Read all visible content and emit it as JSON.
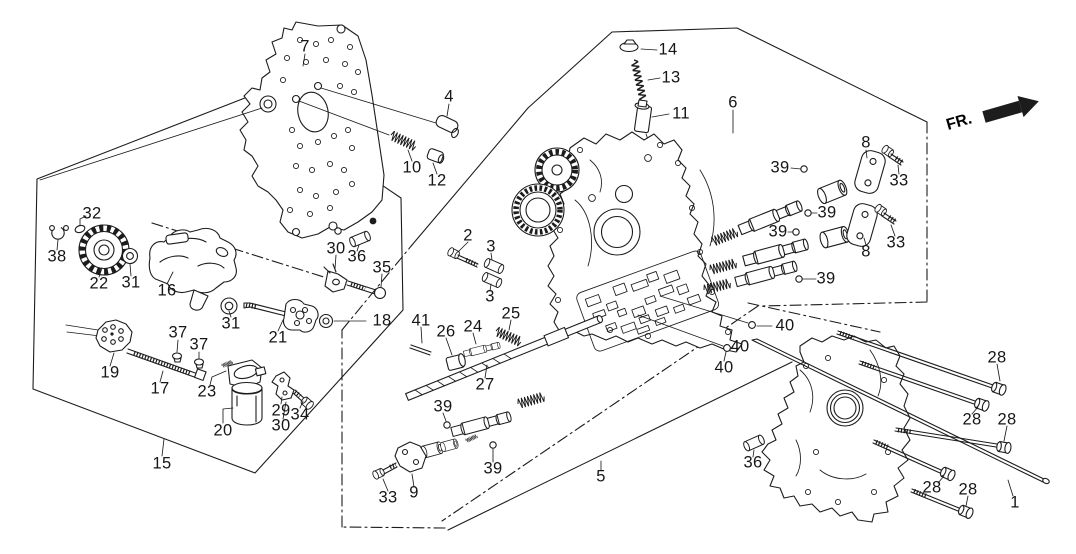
{
  "diagram": {
    "fr_label": "FR.",
    "labels": [
      {
        "n": "7",
        "x": 305,
        "y": 47
      },
      {
        "n": "4",
        "x": 449,
        "y": 97
      },
      {
        "n": "10",
        "x": 412,
        "y": 168
      },
      {
        "n": "12",
        "x": 437,
        "y": 181
      },
      {
        "n": "14",
        "x": 668,
        "y": 50
      },
      {
        "n": "13",
        "x": 671,
        "y": 78
      },
      {
        "n": "11",
        "x": 681,
        "y": 114
      },
      {
        "n": "6",
        "x": 733,
        "y": 103
      },
      {
        "n": "39",
        "x": 780,
        "y": 168
      },
      {
        "n": "8",
        "x": 866,
        "y": 143
      },
      {
        "n": "33",
        "x": 899,
        "y": 181
      },
      {
        "n": "39",
        "x": 827,
        "y": 213
      },
      {
        "n": "39",
        "x": 778,
        "y": 232
      },
      {
        "n": "8",
        "x": 866,
        "y": 252
      },
      {
        "n": "33",
        "x": 896,
        "y": 243
      },
      {
        "n": "39",
        "x": 826,
        "y": 279
      },
      {
        "n": "2",
        "x": 468,
        "y": 236
      },
      {
        "n": "3",
        "x": 491,
        "y": 247
      },
      {
        "n": "3",
        "x": 490,
        "y": 297
      },
      {
        "n": "32",
        "x": 92,
        "y": 214
      },
      {
        "n": "38",
        "x": 57,
        "y": 257
      },
      {
        "n": "22",
        "x": 99,
        "y": 284
      },
      {
        "n": "31",
        "x": 131,
        "y": 283
      },
      {
        "n": "16",
        "x": 167,
        "y": 291
      },
      {
        "n": "31",
        "x": 231,
        "y": 324
      },
      {
        "n": "21",
        "x": 278,
        "y": 338
      },
      {
        "n": "18",
        "x": 382,
        "y": 321
      },
      {
        "n": "19",
        "x": 110,
        "y": 373
      },
      {
        "n": "37",
        "x": 178,
        "y": 333
      },
      {
        "n": "37",
        "x": 199,
        "y": 345
      },
      {
        "n": "17",
        "x": 160,
        "y": 389
      },
      {
        "n": "23",
        "x": 207,
        "y": 392
      },
      {
        "n": "20",
        "x": 223,
        "y": 431
      },
      {
        "n": "29",
        "x": 281,
        "y": 411
      },
      {
        "n": "30",
        "x": 281,
        "y": 426
      },
      {
        "n": "34",
        "x": 300,
        "y": 415
      },
      {
        "n": "15",
        "x": 162,
        "y": 464
      },
      {
        "n": "30",
        "x": 336,
        "y": 249
      },
      {
        "n": "36",
        "x": 357,
        "y": 257
      },
      {
        "n": "35",
        "x": 382,
        "y": 268
      },
      {
        "n": "41",
        "x": 421,
        "y": 321
      },
      {
        "n": "26",
        "x": 446,
        "y": 332
      },
      {
        "n": "24",
        "x": 473,
        "y": 327
      },
      {
        "n": "25",
        "x": 511,
        "y": 314
      },
      {
        "n": "27",
        "x": 485,
        "y": 385
      },
      {
        "n": "39",
        "x": 443,
        "y": 407
      },
      {
        "n": "39",
        "x": 493,
        "y": 469
      },
      {
        "n": "9",
        "x": 414,
        "y": 493
      },
      {
        "n": "33",
        "x": 388,
        "y": 498
      },
      {
        "n": "5",
        "x": 601,
        "y": 477
      },
      {
        "n": "40",
        "x": 785,
        "y": 326
      },
      {
        "n": "40",
        "x": 740,
        "y": 347
      },
      {
        "n": "40",
        "x": 724,
        "y": 368
      },
      {
        "n": "28",
        "x": 997,
        "y": 358
      },
      {
        "n": "28",
        "x": 972,
        "y": 420
      },
      {
        "n": "28",
        "x": 1007,
        "y": 420
      },
      {
        "n": "28",
        "x": 932,
        "y": 488
      },
      {
        "n": "28",
        "x": 968,
        "y": 490
      },
      {
        "n": "1",
        "x": 1015,
        "y": 503
      },
      {
        "n": "36",
        "x": 753,
        "y": 463
      }
    ]
  }
}
